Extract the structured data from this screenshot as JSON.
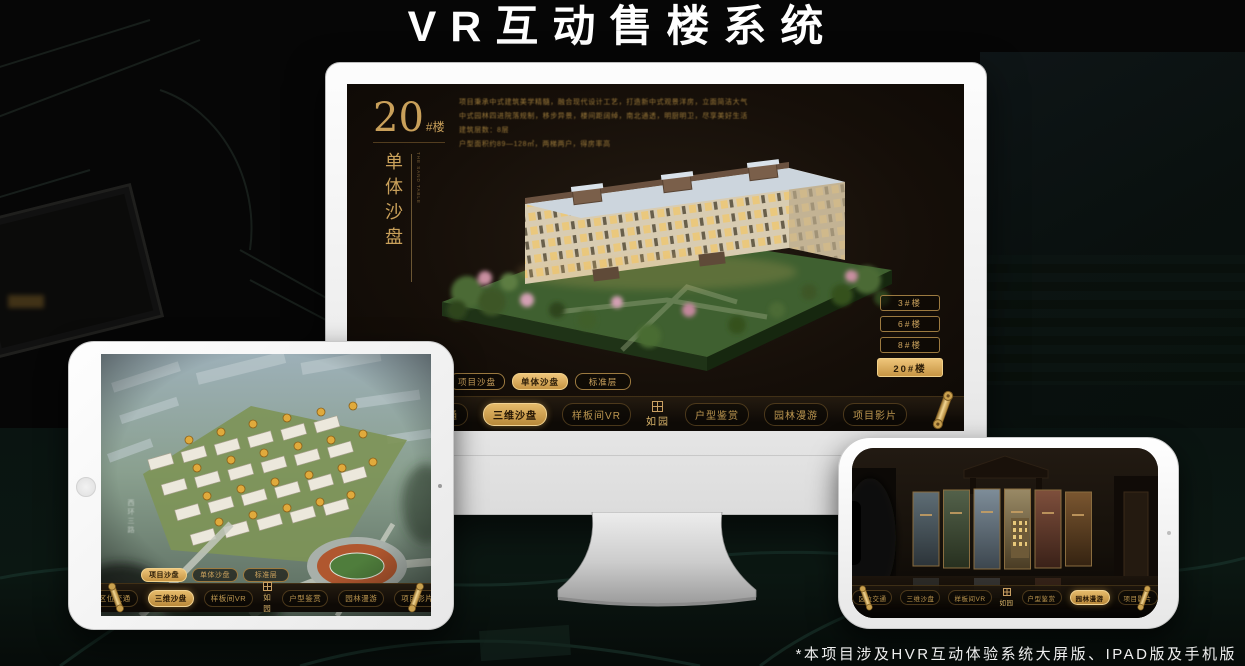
{
  "title": "VR互动售楼系统",
  "footnote": "*本项目涉及HVR互动体验系统大屏版、IPAD版及手机版",
  "brand": {
    "logo_text": "如园"
  },
  "colors": {
    "gold": "#c9a05a",
    "gold_bright": "#ecc377",
    "screen_bg": "#16100a",
    "active_text": "#241504"
  },
  "monitor_ui": {
    "building_number": "20",
    "building_number_suffix": "#楼",
    "building_title_vertical": "单体沙盘",
    "building_title_en": "THE SAND TABLE",
    "description_lines": [
      "项目秉承中式建筑美学精髓，融合现代设计工艺，打造新中式观景洋房，立面简洁大气",
      "中式园林四进院落规制，移步异景，楼间距阔绰，南北通透，明厨明卫，尽享美好生活",
      "建筑层数：8层",
      "户型面积约89—128㎡，两梯两户，得房率高"
    ],
    "floor_buttons": [
      {
        "label": "3#楼",
        "active": false
      },
      {
        "label": "6#楼",
        "active": false
      },
      {
        "label": "8#楼",
        "active": false
      },
      {
        "label": "20#楼",
        "active": true
      }
    ],
    "view_tabs": [
      {
        "label": "项目沙盘",
        "active": false
      },
      {
        "label": "单体沙盘",
        "active": true
      },
      {
        "label": "标准层",
        "active": false
      }
    ],
    "nav_items": [
      {
        "label": "区位交通",
        "active": false
      },
      {
        "label": "三维沙盘",
        "active": true
      },
      {
        "label": "样板间VR",
        "active": false
      },
      {
        "label": "户型鉴赏",
        "active": false
      },
      {
        "label": "园林漫游",
        "active": false
      },
      {
        "label": "项目影片",
        "active": false
      }
    ],
    "logo_text": "如园"
  },
  "tablet_ui": {
    "view_tabs": [
      {
        "label": "项目沙盘",
        "active": true
      },
      {
        "label": "单体沙盘",
        "active": false
      },
      {
        "label": "标准层",
        "active": false
      }
    ],
    "nav_items": [
      {
        "label": "区位交通",
        "active": false
      },
      {
        "label": "三维沙盘",
        "active": true
      },
      {
        "label": "样板间VR",
        "active": false
      },
      {
        "label": "户型鉴赏",
        "active": false
      },
      {
        "label": "园林漫游",
        "active": false
      },
      {
        "label": "项目影片",
        "active": false
      }
    ],
    "logo_text": "如园",
    "road_label": "西环三路"
  },
  "phone_ui": {
    "nav_items": [
      {
        "label": "区位交通",
        "active": false
      },
      {
        "label": "三维沙盘",
        "active": false
      },
      {
        "label": "样板间VR",
        "active": false
      },
      {
        "label": "户型鉴赏",
        "active": false
      },
      {
        "label": "园林漫游",
        "active": true
      },
      {
        "label": "项目影片",
        "active": false
      }
    ],
    "logo_text": "如园"
  }
}
